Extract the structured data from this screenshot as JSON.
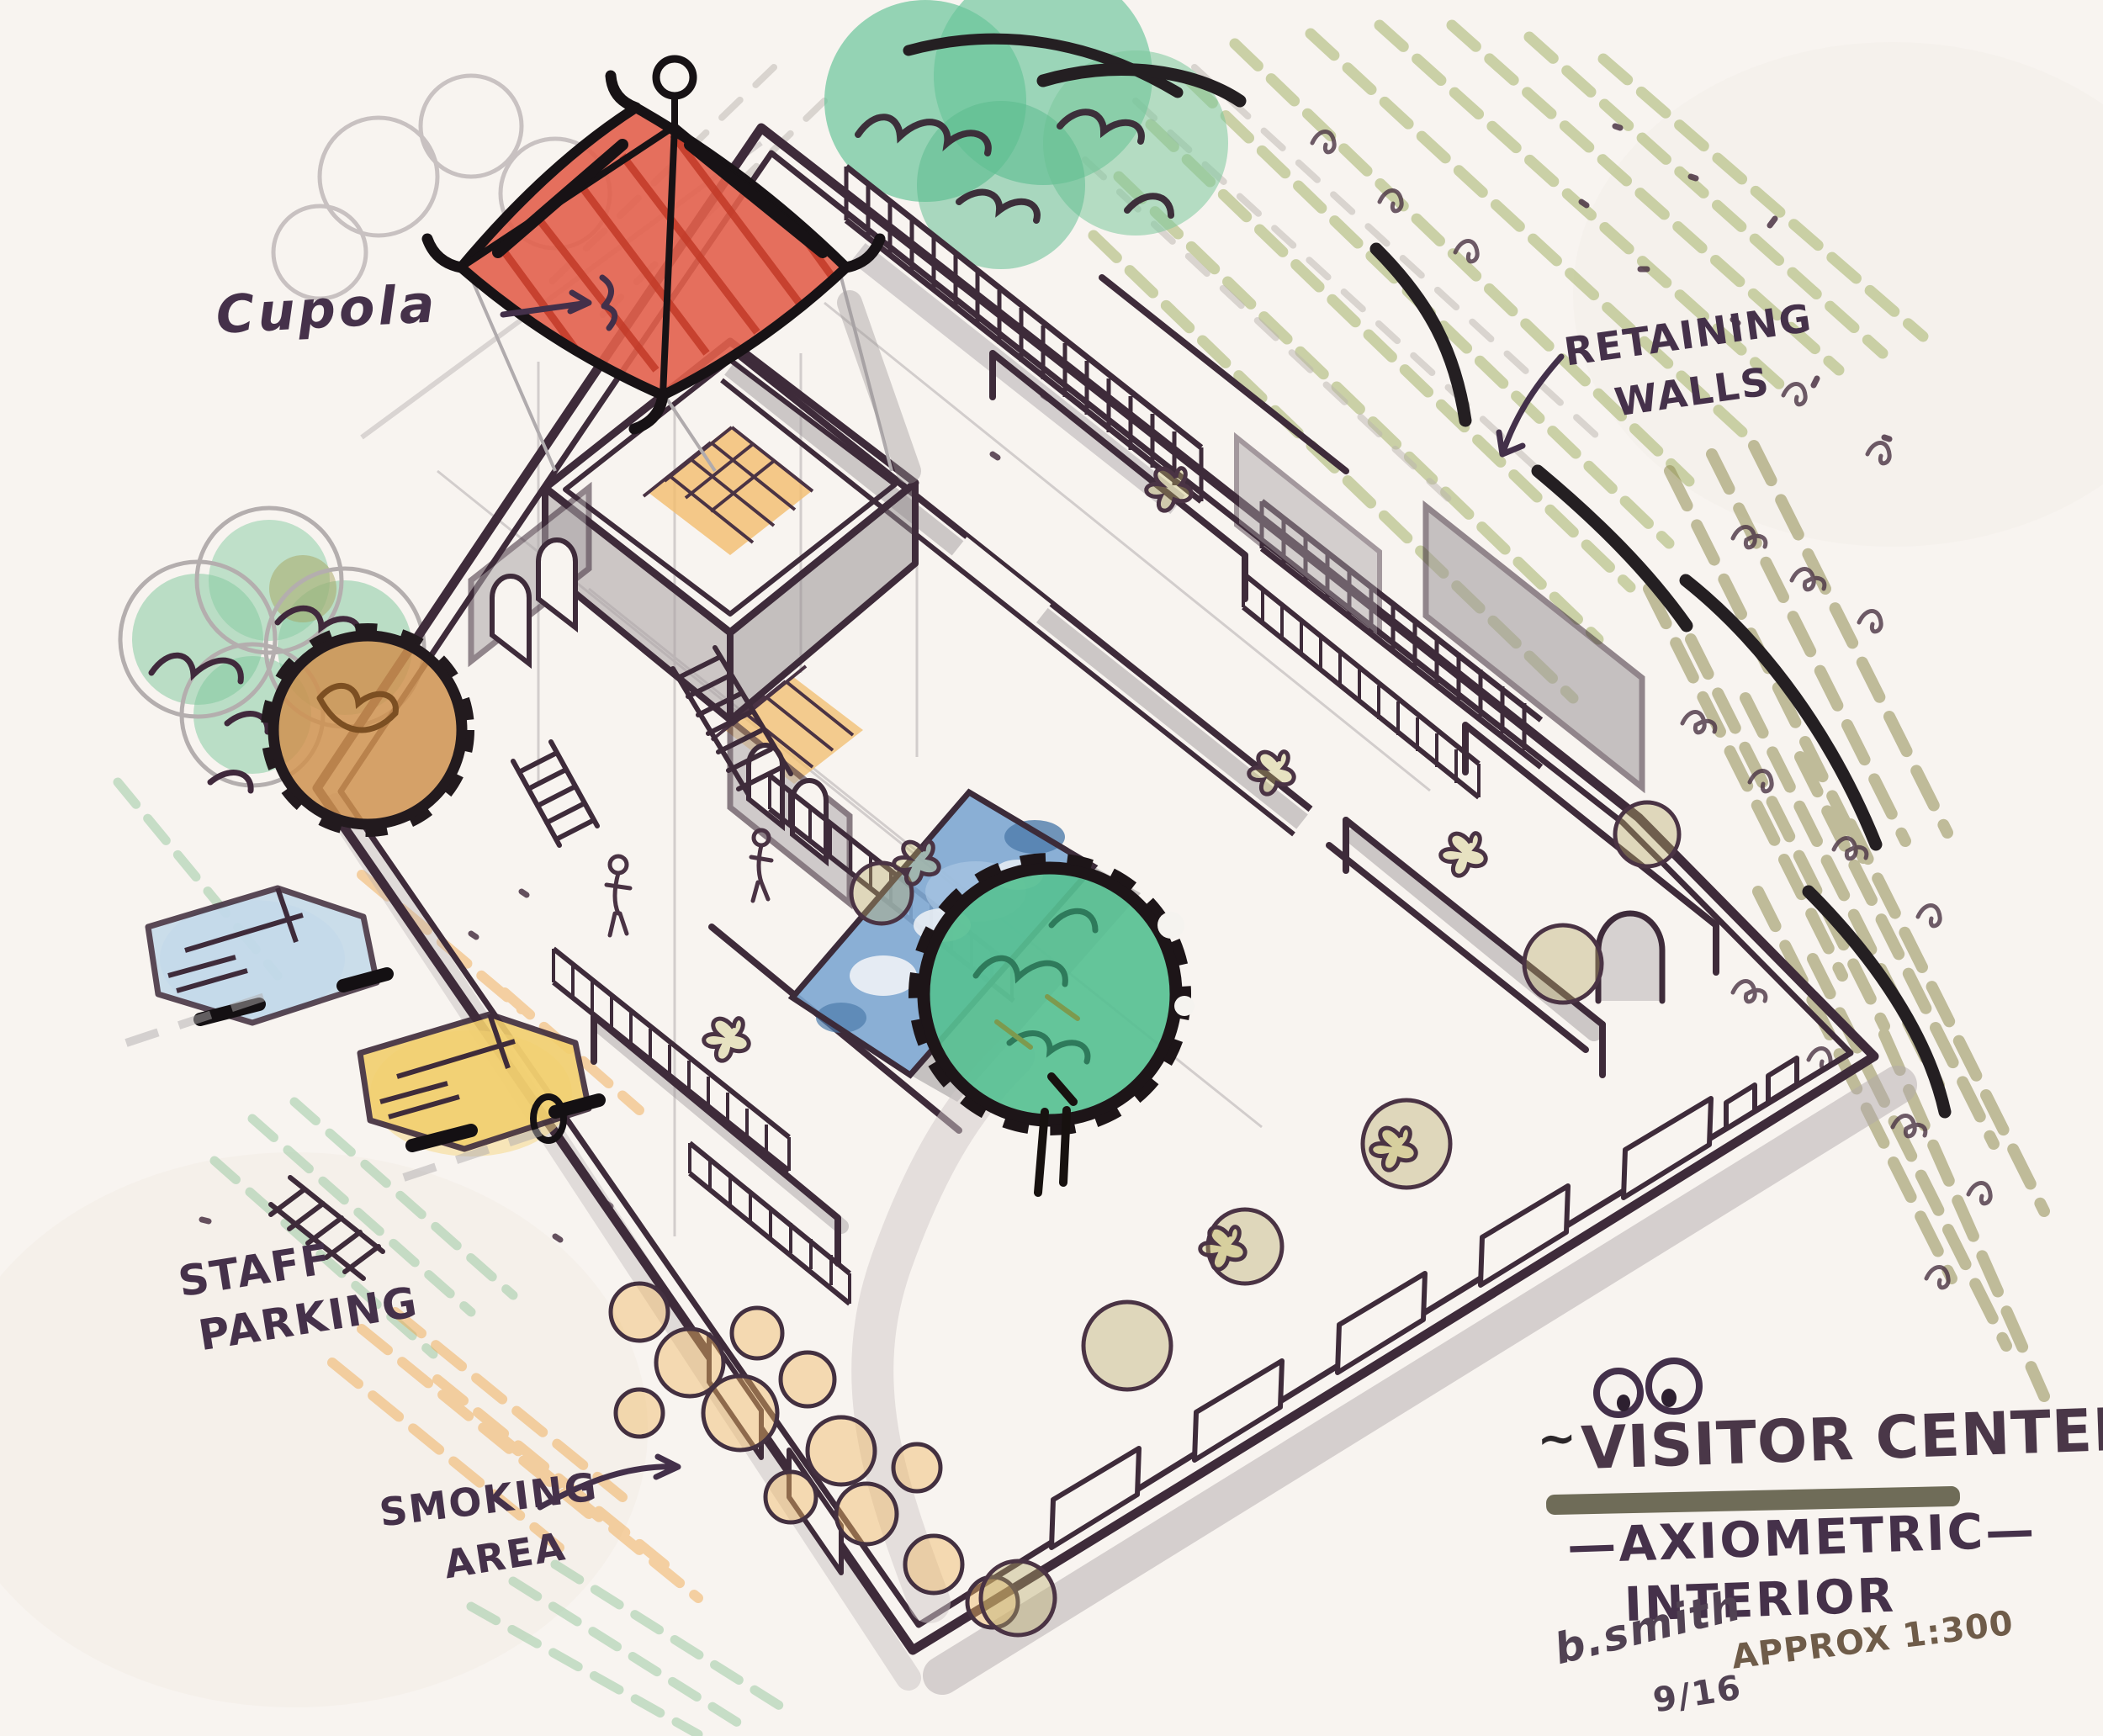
{
  "document": {
    "type": "hand-drawn axonometric architectural sketch",
    "media": "marker and colored pencil on paper"
  },
  "annotations": {
    "cupola": {
      "label": "Cupola"
    },
    "retaining_walls": {
      "line1": "RETAINING",
      "line2": "WALLS"
    },
    "staff_parking": {
      "line1": "STAFF",
      "line2": "PARKING"
    },
    "smoking_area": {
      "line1": "SMOKING",
      "line2": "AREA"
    }
  },
  "title_block": {
    "tilde_left": "~",
    "title": "VISITOR CENTER",
    "title_overlay": "EAST",
    "tilde_right": "~",
    "subtitle": "—AXIOMETRIC—",
    "subtitle2": "INTERIOR",
    "scale_note": "APPROX 1:300",
    "signature": "b.smith",
    "date": "9/16"
  },
  "icons": {
    "eyes_doodle": "googly-eyes-doodle",
    "cupola_arrow": "arrow-right",
    "retaining_arrow": "arrow-down-left",
    "smoking_arrow": "arrow-up-right"
  },
  "palette": {
    "paper": "#f8f4f0",
    "ink": "#4a3344",
    "black_marker": "#241f22",
    "roof_red": "#e0604d",
    "tree_teal": "#57c093",
    "grass_olive": "#8f8c52",
    "hatch_green": "#a4b36a",
    "pool_blue": "#7da7d1",
    "accent_orange": "#f0b964",
    "shadow_gray": "#9b969a",
    "underline_olive": "#63604b"
  }
}
